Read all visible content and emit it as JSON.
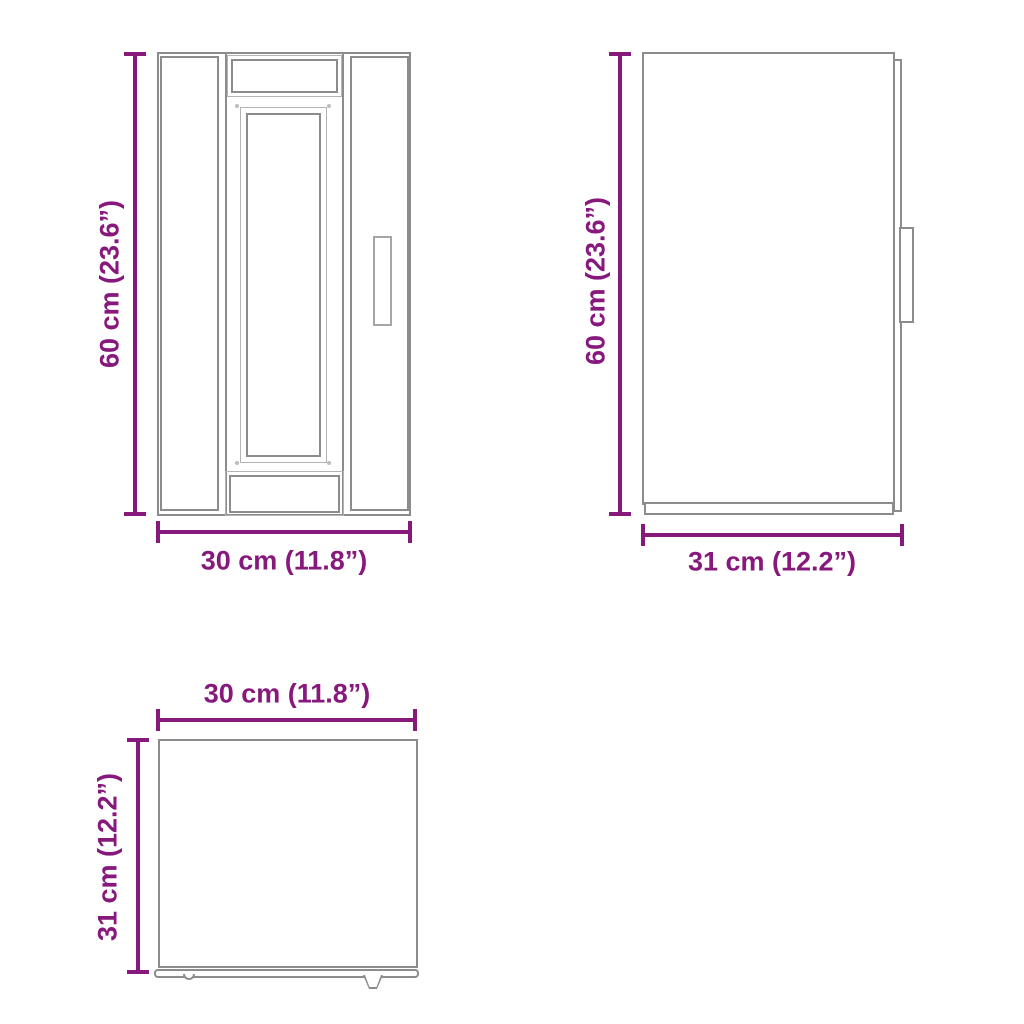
{
  "colors": {
    "dim": "#87187C",
    "outline": "#8C8C8C",
    "outline-light": "#B3B3B3"
  },
  "views": {
    "front": {
      "name": "cabinet front view",
      "height_label": "60 cm (23.6”)",
      "width_label": "30 cm (11.8”)"
    },
    "side": {
      "name": "cabinet side view",
      "height_label": "60 cm (23.6”)",
      "depth_label": "31 cm (12.2”)"
    },
    "top": {
      "name": "cabinet top view",
      "width_label": "30 cm (11.8”)",
      "depth_label": "31 cm (12.2”)"
    }
  }
}
